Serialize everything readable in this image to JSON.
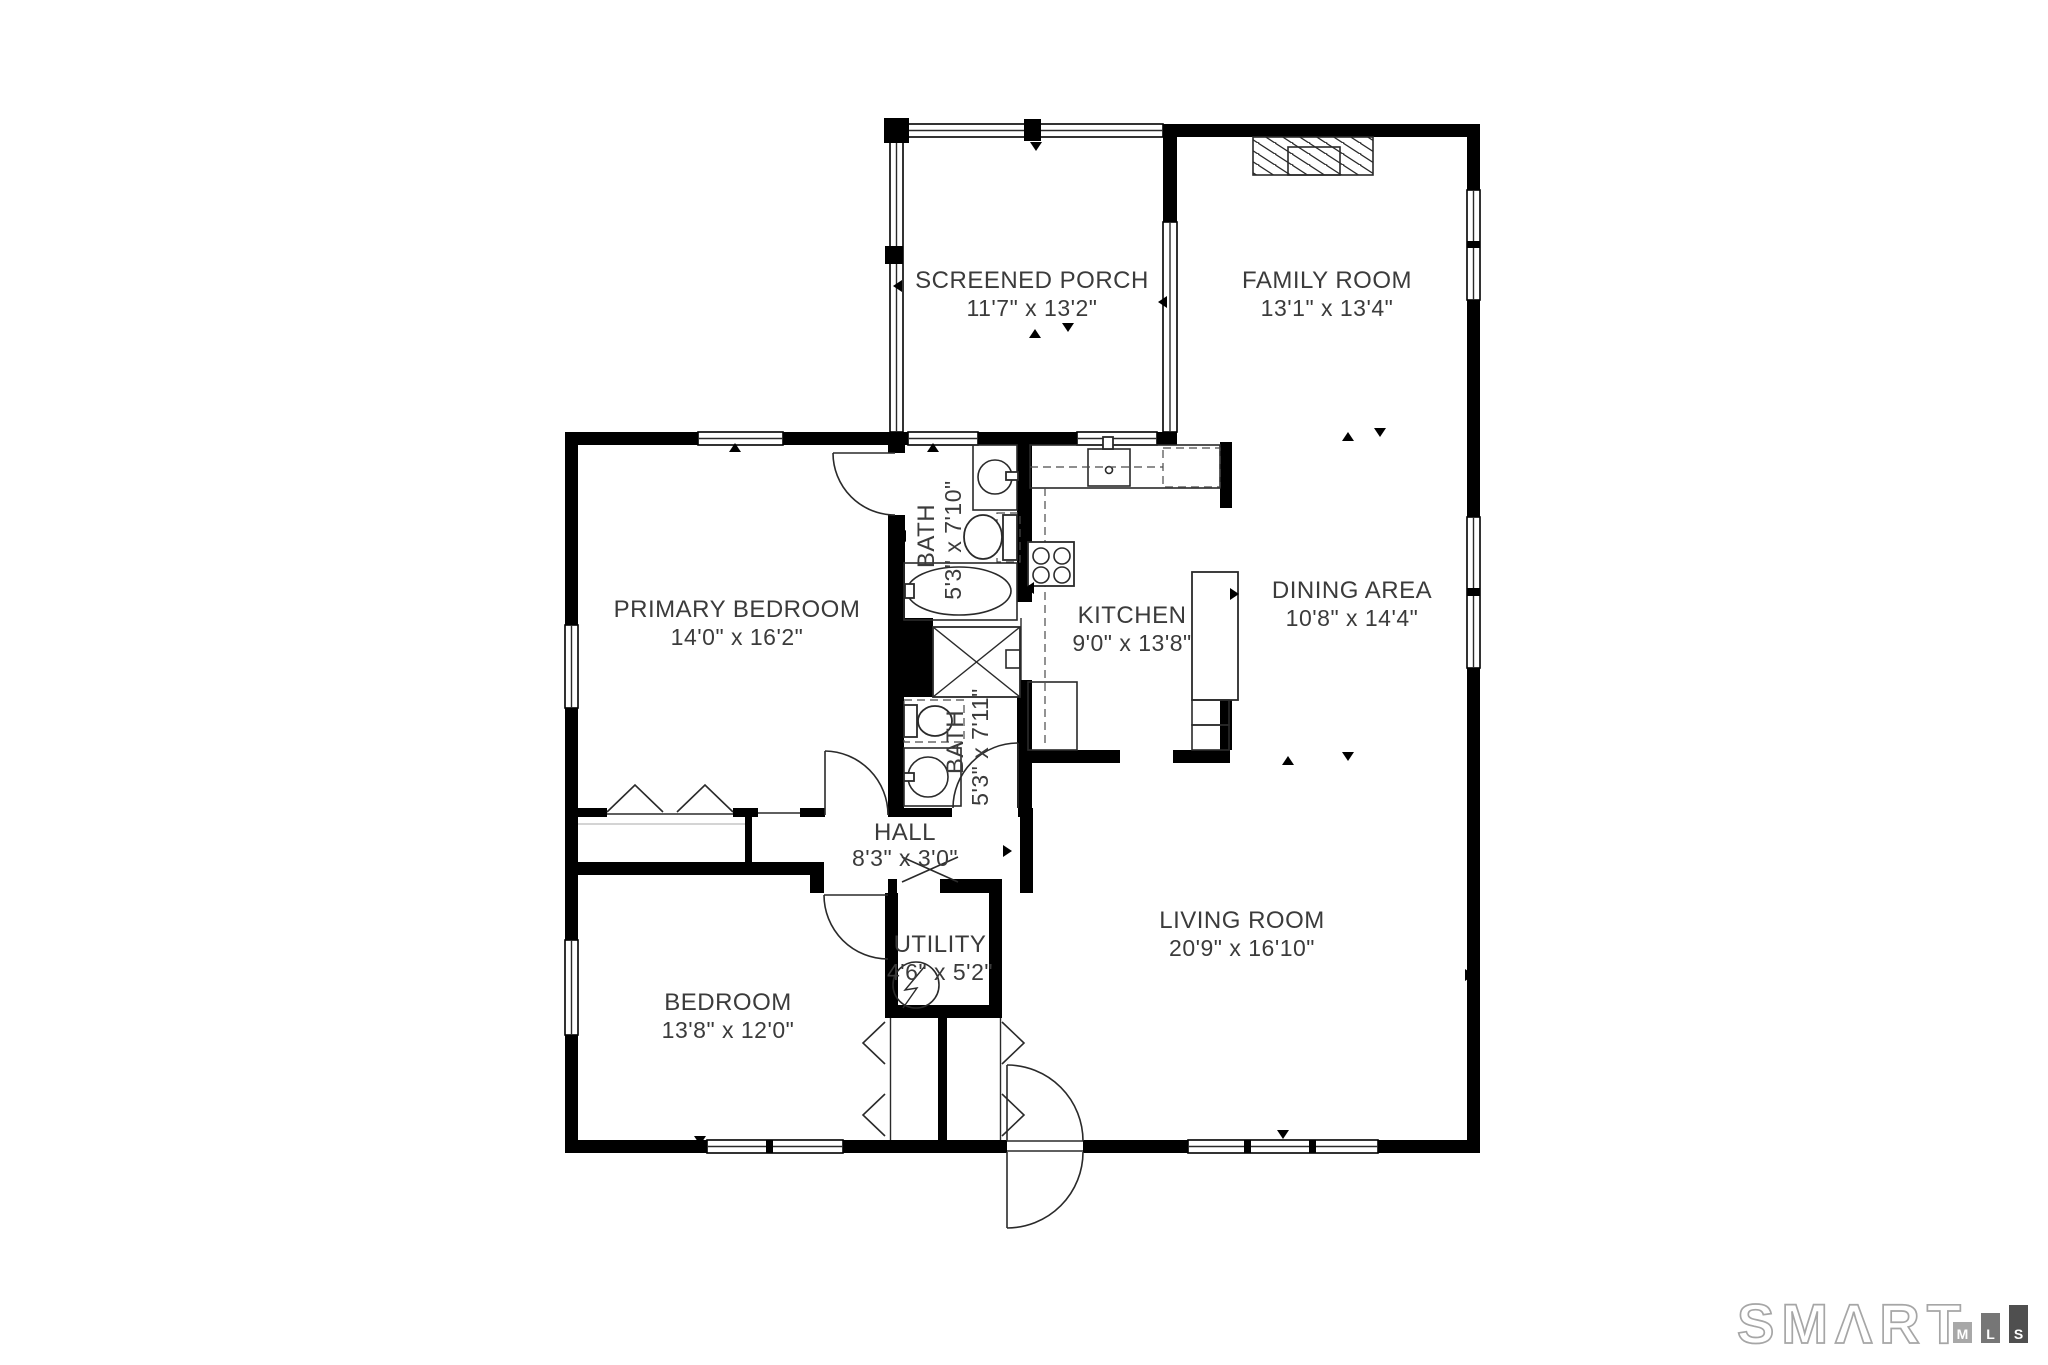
{
  "rooms": [
    {
      "name": "SCREENED PORCH",
      "dims": "11'7\" x 13'2\""
    },
    {
      "name": "FAMILY ROOM",
      "dims": "13'1\" x 13'4\""
    },
    {
      "name": "PRIMARY BEDROOM",
      "dims": "14'0\" x 16'2\""
    },
    {
      "name": "BATH",
      "dims": "5'3\" x 7'10\""
    },
    {
      "name": "KITCHEN",
      "dims": "9'0\" x 13'8\""
    },
    {
      "name": "DINING AREA",
      "dims": "10'8\" x 14'4\""
    },
    {
      "name": "BATH",
      "dims": "5'3\" x 7'11\""
    },
    {
      "name": "HALL",
      "dims": "8'3\" x 3'0\""
    },
    {
      "name": "UTILITY",
      "dims": "4'6\" x 5'2\""
    },
    {
      "name": "BEDROOM",
      "dims": "13'8\" x 12'0\""
    },
    {
      "name": "LIVING ROOM",
      "dims": "20'9\" x 16'10\""
    }
  ],
  "logo": {
    "brand": "SMΛRT",
    "mls_letters": [
      "M",
      "L",
      "S"
    ],
    "bar_colors": [
      "#a8a8a8",
      "#767676",
      "#4f4f4f"
    ]
  },
  "colors": {
    "wall": "#000000",
    "text": "#3b3b3b",
    "background": "#ffffff"
  }
}
